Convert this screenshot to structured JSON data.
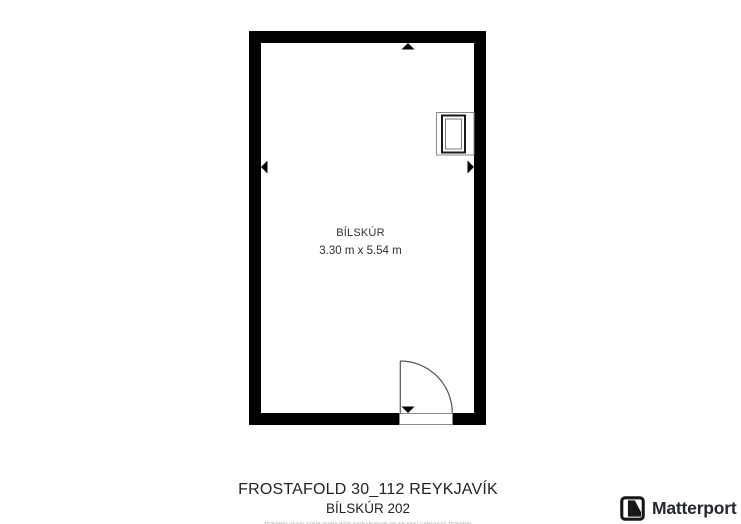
{
  "floorplan": {
    "room": {
      "label": "BÍLSKÚR",
      "dimensions": "3.30 m x 5.54 m",
      "width_m": 3.3,
      "length_m": 5.54
    },
    "features": [
      "door-swing-bottom",
      "appliance-fixture-top-right",
      "dimension-arrow-up",
      "dimension-arrow-down",
      "dimension-arrow-left",
      "dimension-arrow-right"
    ],
    "colors": {
      "wall": "#000000",
      "thin_line": "#555555",
      "muted_outline": "#8a8a8a",
      "room_text": "#2f2f2f"
    }
  },
  "footer": {
    "address": "FROSTAFOLD 30_112 REYKJAVÍK",
    "unit": "BÍLSKÚR 202",
    "disclaimer": "TEIKNING ÞESSI SÝNIR INNRA RÝMI EIGNARINNAR OG ER EKKI SAMÞYKKT TEIKNING"
  },
  "branding": {
    "name": "Matterport",
    "color": "#24272b"
  }
}
